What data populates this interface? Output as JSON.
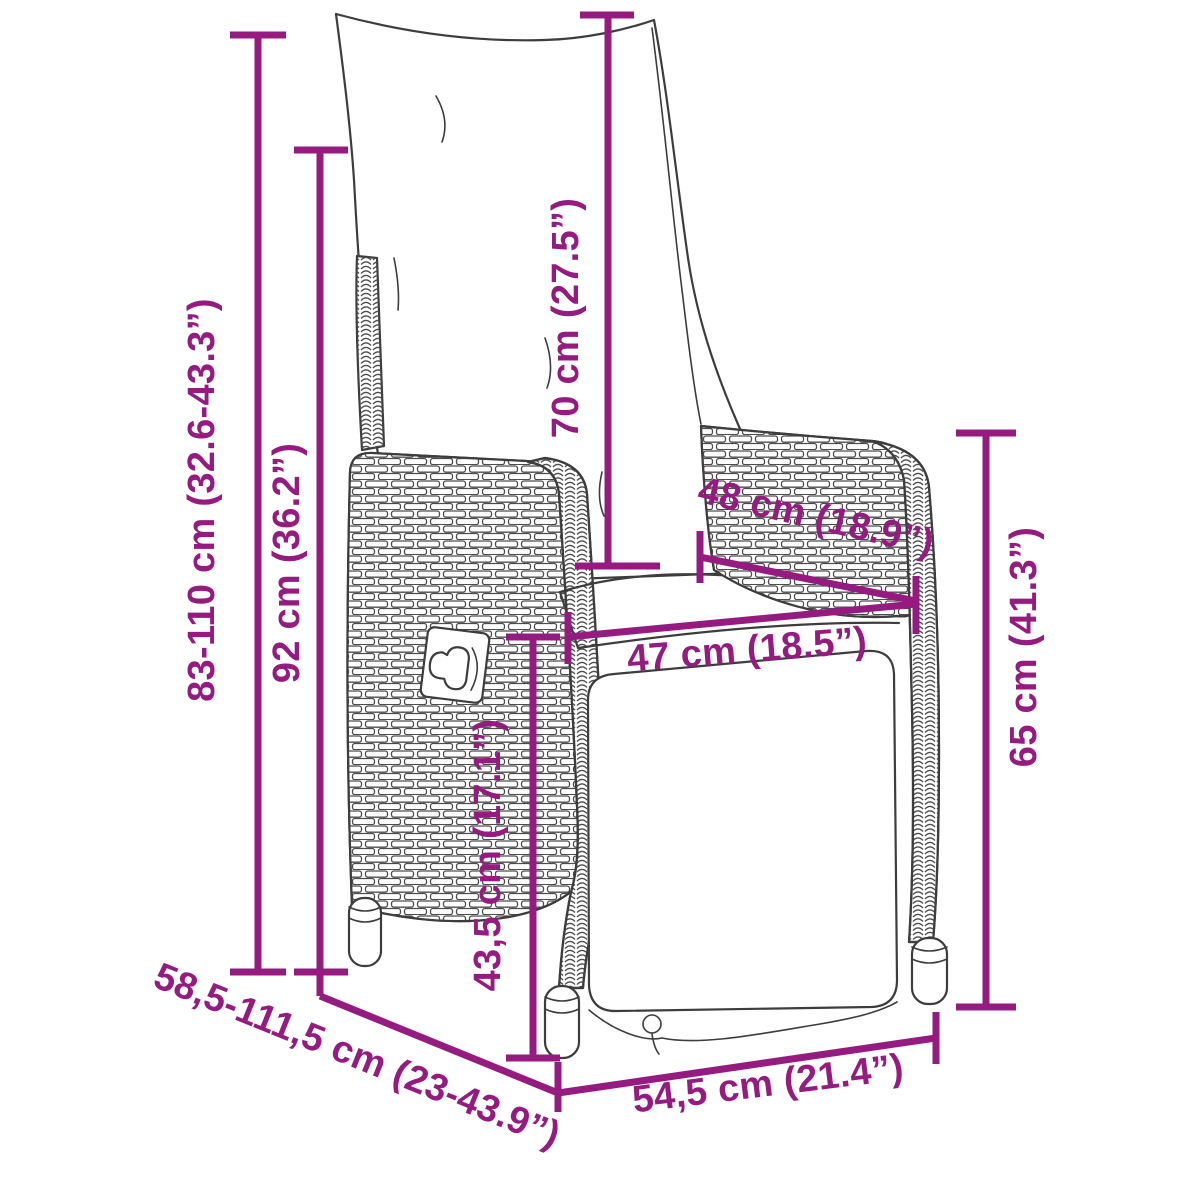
{
  "diagram": {
    "accent_color": "#951B81",
    "art_color": "#3d3d3d",
    "subject": "reclining-garden-chair-side-view",
    "dimensions": {
      "total_height": "83-110 cm (32.6-43.3”)",
      "backrest_height": "92 cm (36.2”)",
      "back_cushion_length": "70 cm (27.5”)",
      "seat_depth": "48 cm (18.9”)",
      "seat_width": "47 cm (18.5”)",
      "seat_height": "43,5 cm (17.1”)",
      "armrest_height": "65 cm (41.3”)",
      "depth_range": "58,5-111,5 cm (23-43.9”)",
      "base_width": "54,5 cm (21.4”)"
    }
  }
}
